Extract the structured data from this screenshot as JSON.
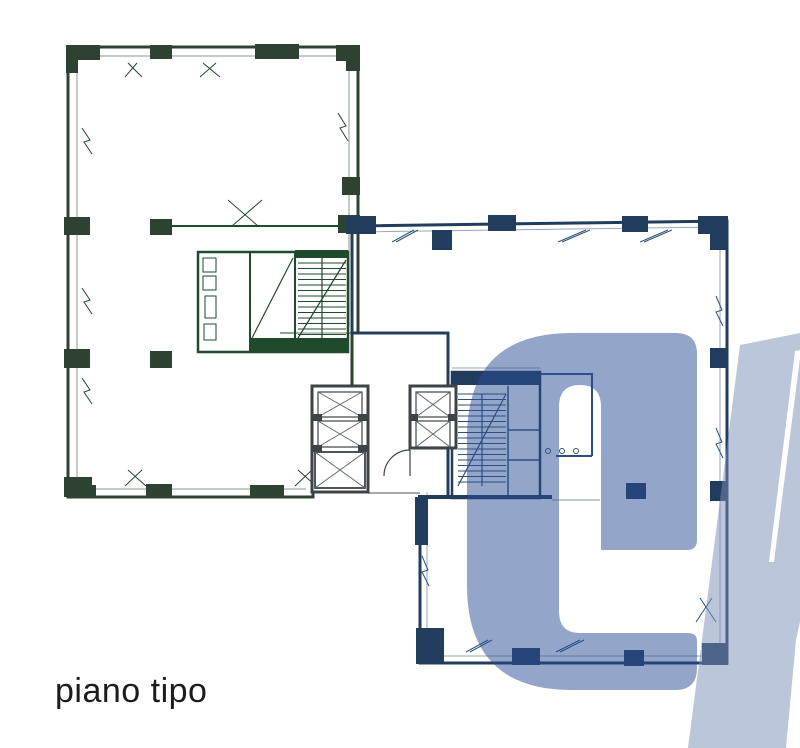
{
  "caption": {
    "text": "piano tipo"
  },
  "plan": {
    "wings": [
      {
        "id": "green-wing",
        "label": "upper-left wing (green highlight)"
      },
      {
        "id": "blue-wing",
        "label": "lower-right wing (blue highlight)"
      }
    ],
    "core": {
      "label": "central core: elevator shafts and stairwells"
    }
  },
  "watermark": {
    "visible_letter": "C",
    "partial_shape": "diagonal letter fragment cut off at right edge"
  },
  "colors": {
    "page_bg": "#ffffff",
    "green_fill": "#6ec48b",
    "green_wall": "#2e4231",
    "green_line": "#1f4a2b",
    "blue_fill": "#97b8e3",
    "blue_wall": "#223c5e",
    "blue_line": "#2d5078",
    "core_wall": "#3c4448",
    "watermark_c": "rgba(40,75,145,0.50)",
    "watermark_bar": "rgba(122,141,181,0.50)",
    "caption_color": "#1c1c1c"
  }
}
